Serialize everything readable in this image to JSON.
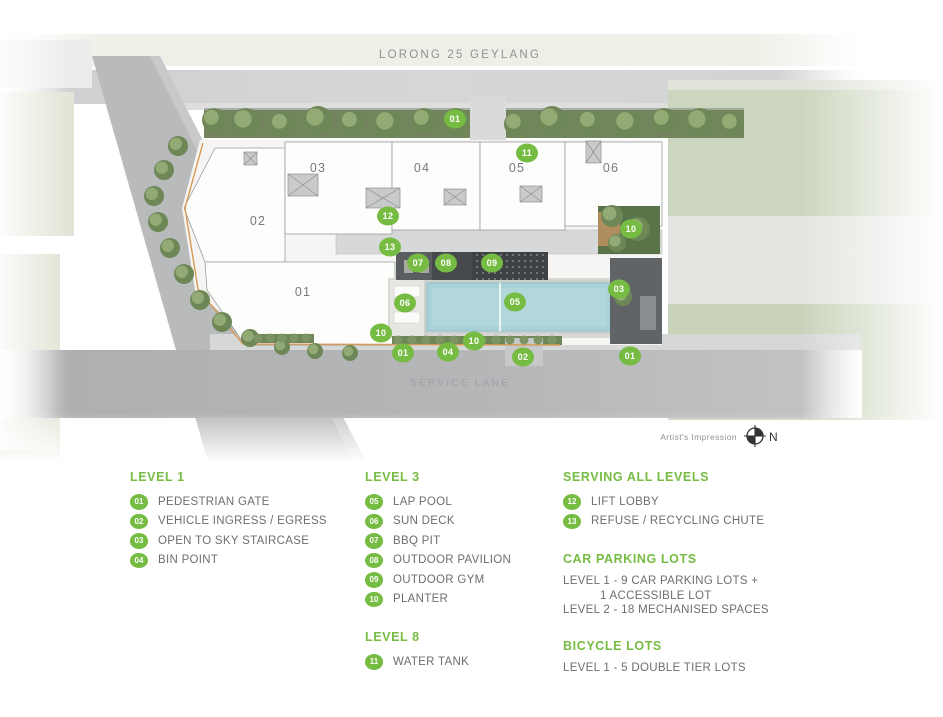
{
  "colors": {
    "accent_green": "#76bc43",
    "legend_text_gray": "#6d6e70",
    "road_label_gray": "#8f9194",
    "pool_blue": "#a9d2d8"
  },
  "plan": {
    "top_road_label": "LORONG 25 GEYLANG",
    "bottom_road_label": "SERVICE LANE",
    "credit": "Artist's Impression",
    "north": "N",
    "blocks": [
      {
        "label": "01",
        "x": 303,
        "y": 296
      },
      {
        "label": "02",
        "x": 258,
        "y": 225
      },
      {
        "label": "03",
        "x": 318,
        "y": 172
      },
      {
        "label": "04",
        "x": 422,
        "y": 172
      },
      {
        "label": "05",
        "x": 517,
        "y": 172
      },
      {
        "label": "06",
        "x": 611,
        "y": 172
      }
    ],
    "markers": [
      {
        "num": "01",
        "x": 455,
        "y": 119
      },
      {
        "num": "11",
        "x": 527,
        "y": 153
      },
      {
        "num": "12",
        "x": 388,
        "y": 216
      },
      {
        "num": "13",
        "x": 390,
        "y": 247
      },
      {
        "num": "07",
        "x": 418,
        "y": 263
      },
      {
        "num": "08",
        "x": 446,
        "y": 263
      },
      {
        "num": "09",
        "x": 492,
        "y": 263
      },
      {
        "num": "06",
        "x": 405,
        "y": 303
      },
      {
        "num": "05",
        "x": 515,
        "y": 302
      },
      {
        "num": "10",
        "x": 631,
        "y": 229
      },
      {
        "num": "03",
        "x": 619,
        "y": 289
      },
      {
        "num": "10",
        "x": 381,
        "y": 333
      },
      {
        "num": "01",
        "x": 403,
        "y": 353
      },
      {
        "num": "04",
        "x": 448,
        "y": 352
      },
      {
        "num": "10",
        "x": 474,
        "y": 341
      },
      {
        "num": "02",
        "x": 523,
        "y": 357
      },
      {
        "num": "01",
        "x": 630,
        "y": 356
      }
    ]
  },
  "legend": {
    "columns": [
      {
        "sections": [
          {
            "title": "LEVEL 1",
            "items": [
              {
                "num": "01",
                "label": "PEDESTRIAN GATE"
              },
              {
                "num": "02",
                "label": "VEHICLE INGRESS / EGRESS"
              },
              {
                "num": "03",
                "label": "OPEN TO SKY STAIRCASE"
              },
              {
                "num": "04",
                "label": "BIN POINT"
              }
            ]
          }
        ]
      },
      {
        "sections": [
          {
            "title": "LEVEL 3",
            "items": [
              {
                "num": "05",
                "label": "LAP POOL"
              },
              {
                "num": "06",
                "label": "SUN DECK"
              },
              {
                "num": "07",
                "label": "BBQ PIT"
              },
              {
                "num": "08",
                "label": "OUTDOOR PAVILION"
              },
              {
                "num": "09",
                "label": "OUTDOOR GYM"
              },
              {
                "num": "10",
                "label": "PLANTER"
              }
            ]
          },
          {
            "title": "LEVEL 8",
            "items": [
              {
                "num": "11",
                "label": "WATER TANK"
              }
            ]
          }
        ]
      },
      {
        "sections": [
          {
            "title": "SERVING ALL LEVELS",
            "items": [
              {
                "num": "12",
                "label": "LIFT LOBBY"
              },
              {
                "num": "13",
                "label": "REFUSE / RECYCLING CHUTE"
              }
            ]
          },
          {
            "title": "CAR PARKING LOTS",
            "lines": [
              {
                "text": "LEVEL 1 - 9 CAR PARKING LOTS +",
                "indent": false
              },
              {
                "text": "1 ACCESSIBLE LOT",
                "indent": true
              },
              {
                "text": "LEVEL 2 - 18 MECHANISED SPACES",
                "indent": false
              }
            ]
          },
          {
            "title": "BICYCLE LOTS",
            "lines": [
              {
                "text": "LEVEL 1 - 5 DOUBLE TIER LOTS",
                "indent": false
              }
            ]
          }
        ]
      }
    ]
  }
}
